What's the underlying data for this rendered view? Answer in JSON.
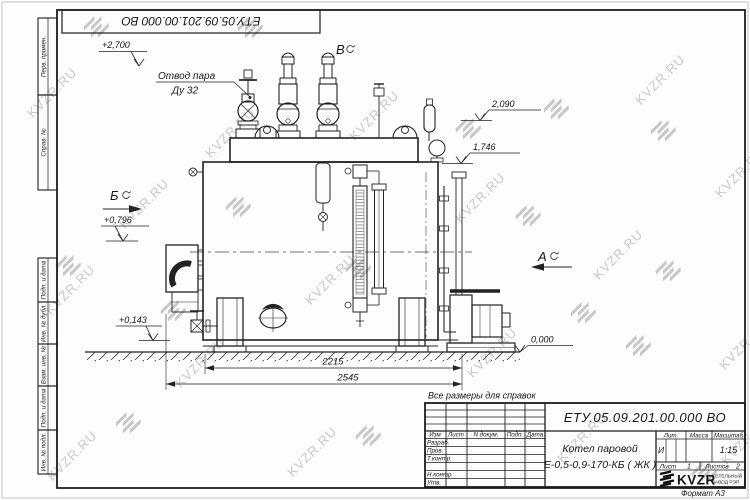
{
  "watermark": {
    "text": "KVZR.RU"
  },
  "doc_number": "ЕТУ.05.09.201.00.000  ВО",
  "note": "Все размеры для справок",
  "side_columns": {
    "perv": "Перв. примен.",
    "sprav": "Справ. №",
    "podp1": "Подп. и дата",
    "inv_dubl": "Инв. № дубл.",
    "vzam": "Взам. инв. №",
    "podp2": "Подп. и дата",
    "inv_podl": "Инв. № подл."
  },
  "drawing": {
    "callout_line1": "Отвод пара",
    "callout_line2": "Ду 32",
    "elevations": {
      "e2700": "+2,700",
      "e2090": "2,090",
      "e1746": "1,746",
      "e0796": "+0,796",
      "e0143": "+0,143",
      "e0000": "0,000"
    },
    "dimensions": {
      "inner": "2215",
      "outer": "2545"
    },
    "views": {
      "a": "А",
      "b": "Б",
      "v": "В"
    }
  },
  "title_block": {
    "name_line1": "Котел паровой",
    "name_line2": "Е-0,5-0,9-170-КБ ( ЖК )",
    "cols": {
      "izm": "Изм",
      "list": "Лист",
      "ndoc": "N докум.",
      "podp": "Подп.",
      "data": "Дата"
    },
    "rows": {
      "razrab": "Разраб.",
      "prov": "Пров.",
      "tkontr": "Т.контр.",
      "nkontr": "Н.контр.",
      "utv": "Утв."
    },
    "lit_label": "Лит.",
    "mass_label": "Масса",
    "scale_label": "Масштаб",
    "lit_value": "И",
    "scale_value": "1:15",
    "sheet_label": "Лист",
    "sheet_value": "1",
    "sheets_label": "Листов",
    "sheets_value": "2",
    "logo": {
      "name": "KVZR",
      "sub1": "КОТЕЛЬНЫЙ",
      "sub2": "ЗАВОД РЭП"
    },
    "format": "Формат А3"
  }
}
